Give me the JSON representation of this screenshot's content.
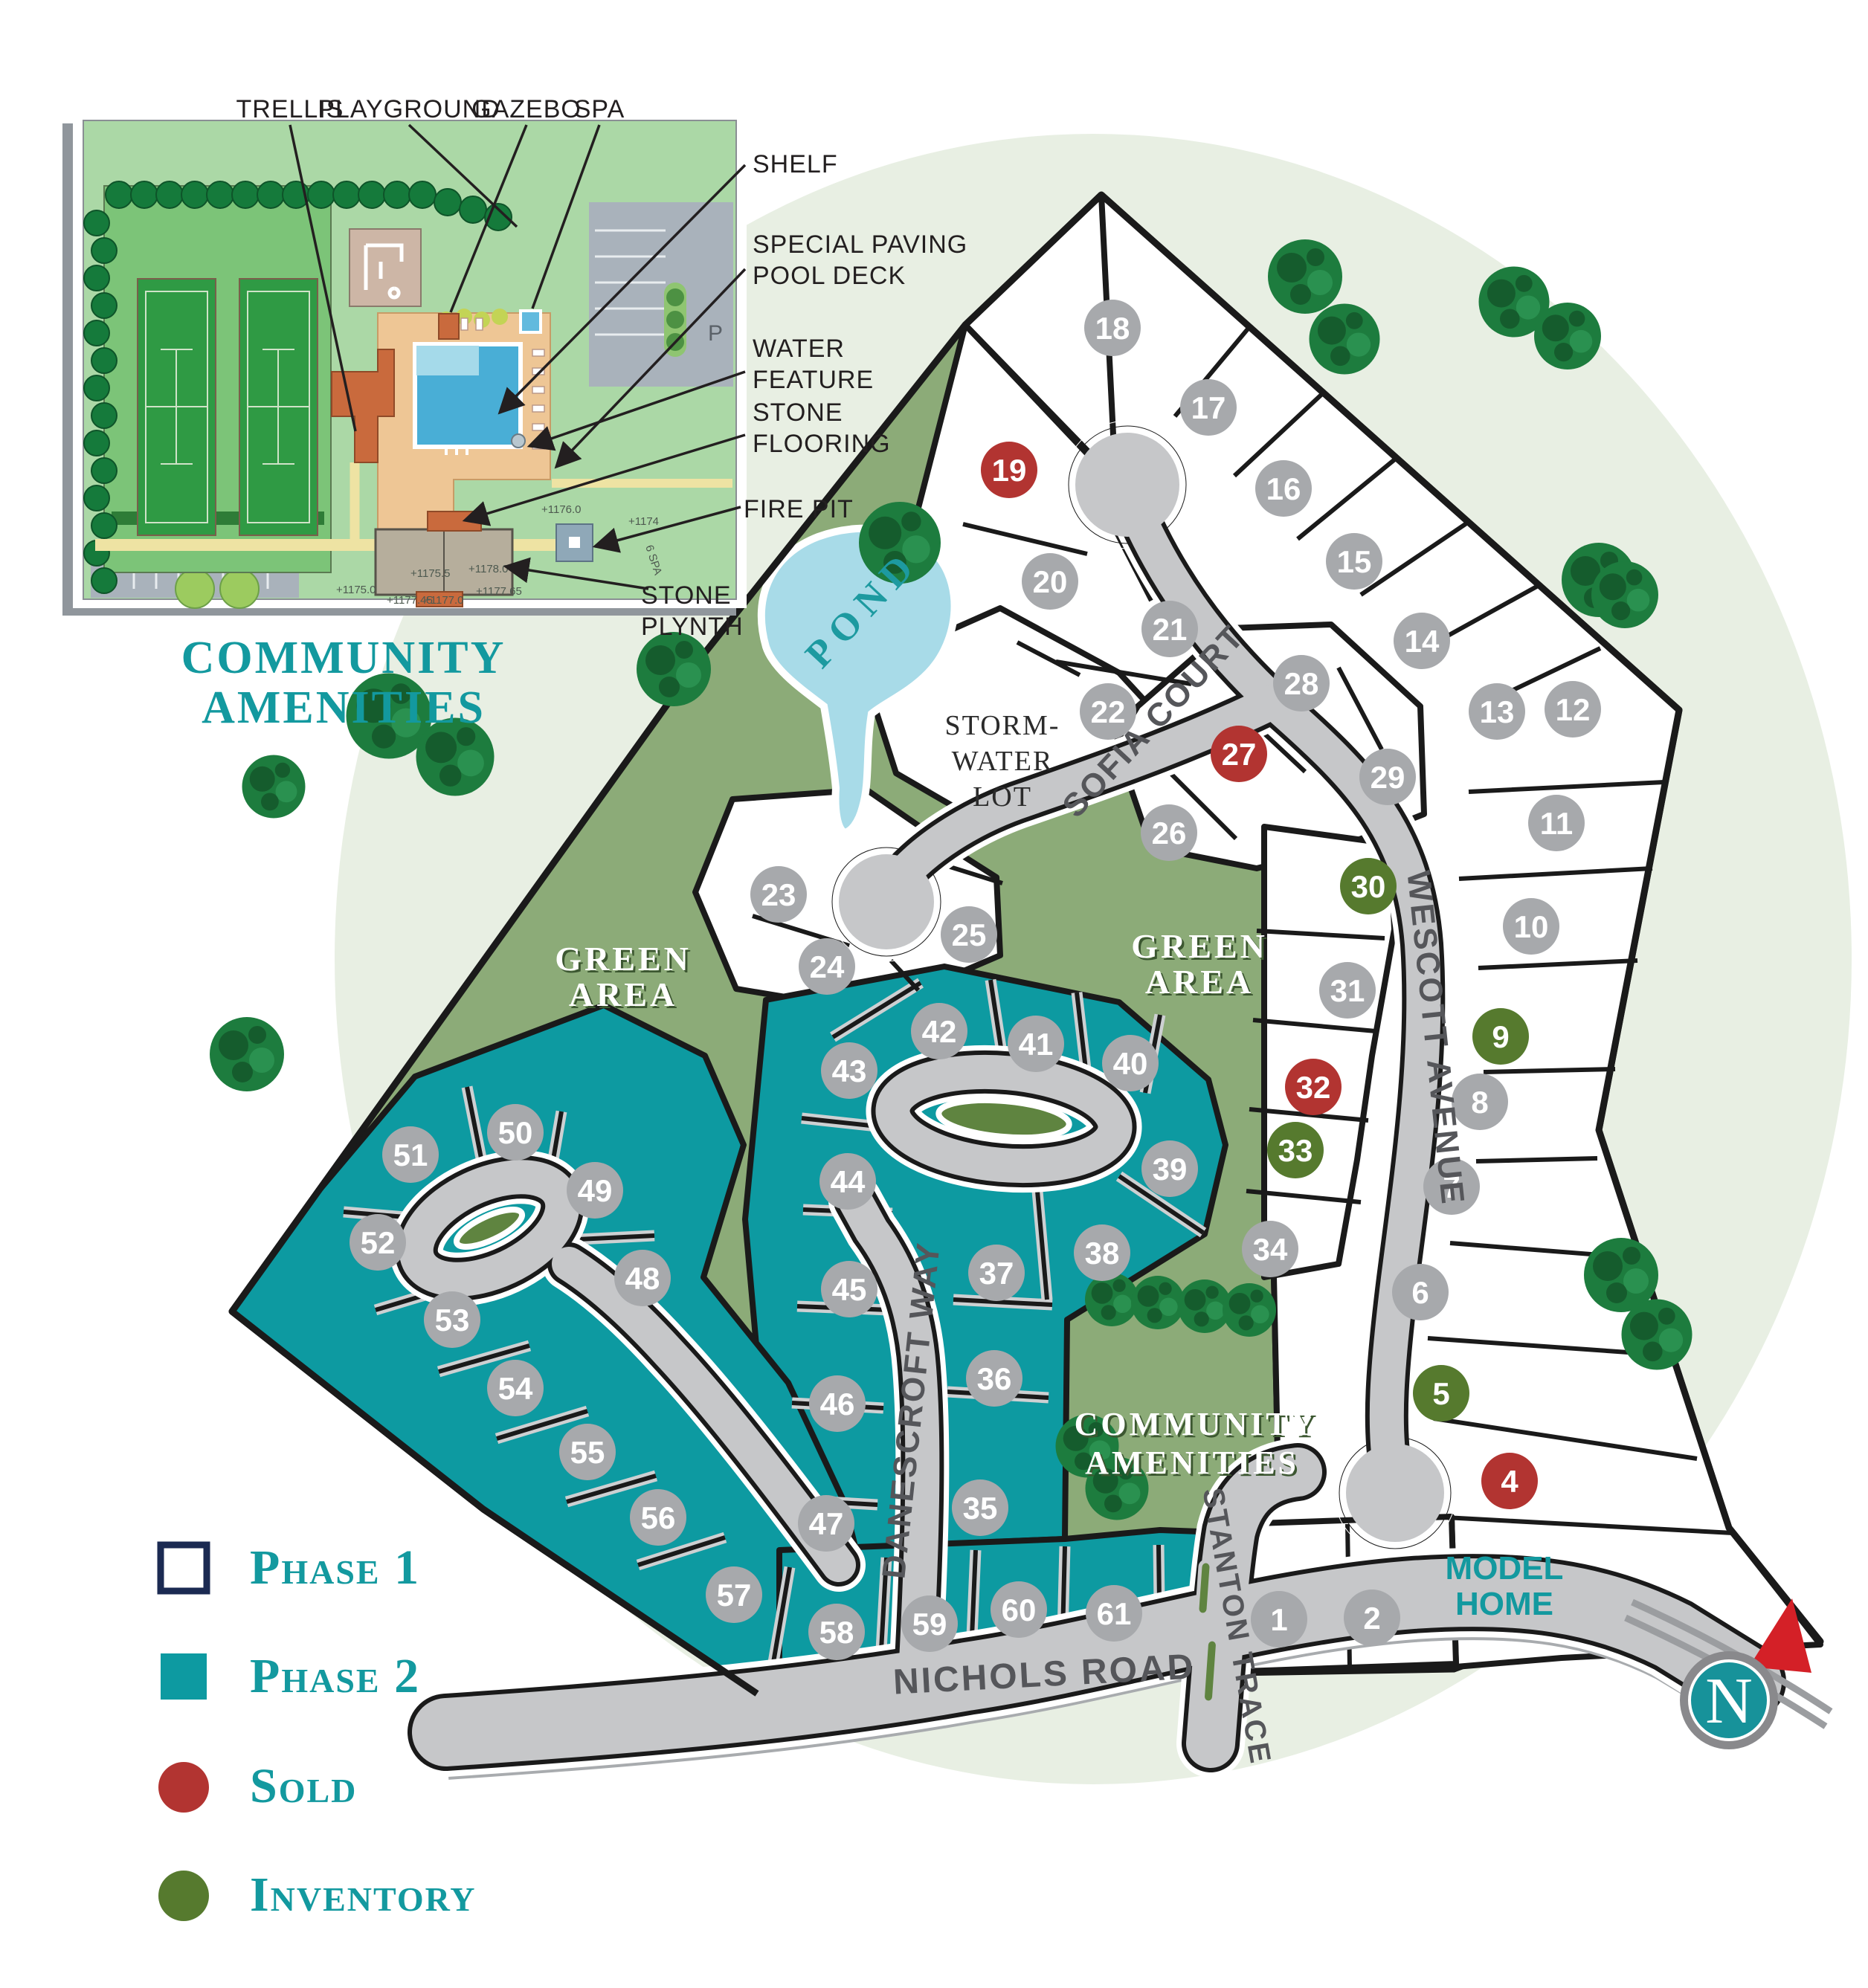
{
  "inset": {
    "title_line1": "COMMUNITY",
    "title_line2": "AMENITIES",
    "callouts": {
      "trellis": "TRELLIS",
      "playground": "PLAYGROUND",
      "gazebo": "GAZEBO",
      "spa": "SPA",
      "shelf": "SHELF",
      "paving1": "SPECIAL PAVING",
      "paving2": "POOL DECK",
      "water1": "WATER",
      "water2": "FEATURE",
      "stone1": "STONE",
      "stone2": "FLOORING",
      "firepit": "FIRE PIT",
      "plynth1": "STONE",
      "plynth2": "PLYNTH"
    },
    "parking": "P",
    "elevations": [
      "+1176.0",
      "+1175.5",
      "+1178.0",
      "+1177.0",
      "+1175.0",
      "+1177.45",
      "+1174",
      "+1177.65",
      "6 SPA"
    ]
  },
  "map": {
    "streets": {
      "sofia": "SOFIA COURT",
      "wescott": "WESCOTT AVENUE",
      "danescroft": "DANESCROFT WAY",
      "stanton": "STANTON TRACE",
      "nichols": "NICHOLS ROAD"
    },
    "labels": {
      "pond": "POND",
      "storm1": "STORM-",
      "storm2": "WATER",
      "storm3": "LOT",
      "green1": "GREEN",
      "green2": "AREA",
      "community1": "COMMUNITY",
      "community2": "AMENITIES",
      "model1": "MODEL",
      "model2": "HOME",
      "compass": "N"
    },
    "statuses": {
      "phase1": "#a7a9ac",
      "phase2": "#a7a9ac",
      "sold": "#b23431",
      "inventory": "#567a2e"
    },
    "lots": [
      {
        "num": 1,
        "status": "phase1"
      },
      {
        "num": 2,
        "status": "phase1"
      },
      {
        "num": 4,
        "status": "sold"
      },
      {
        "num": 5,
        "status": "inventory"
      },
      {
        "num": 6,
        "status": "phase1"
      },
      {
        "num": 7,
        "status": "phase1"
      },
      {
        "num": 8,
        "status": "phase1"
      },
      {
        "num": 9,
        "status": "inventory"
      },
      {
        "num": 10,
        "status": "phase1"
      },
      {
        "num": 11,
        "status": "phase1"
      },
      {
        "num": 12,
        "status": "phase1"
      },
      {
        "num": 13,
        "status": "phase1"
      },
      {
        "num": 14,
        "status": "phase1"
      },
      {
        "num": 15,
        "status": "phase1"
      },
      {
        "num": 16,
        "status": "phase1"
      },
      {
        "num": 17,
        "status": "phase1"
      },
      {
        "num": 18,
        "status": "phase1"
      },
      {
        "num": 19,
        "status": "sold"
      },
      {
        "num": 20,
        "status": "phase1"
      },
      {
        "num": 21,
        "status": "phase1"
      },
      {
        "num": 22,
        "status": "phase1"
      },
      {
        "num": 23,
        "status": "phase1"
      },
      {
        "num": 24,
        "status": "phase1"
      },
      {
        "num": 25,
        "status": "phase1"
      },
      {
        "num": 26,
        "status": "phase1"
      },
      {
        "num": 27,
        "status": "sold"
      },
      {
        "num": 28,
        "status": "phase1"
      },
      {
        "num": 29,
        "status": "phase1"
      },
      {
        "num": 30,
        "status": "inventory"
      },
      {
        "num": 31,
        "status": "phase1"
      },
      {
        "num": 32,
        "status": "sold"
      },
      {
        "num": 33,
        "status": "inventory"
      },
      {
        "num": 34,
        "status": "phase1"
      },
      {
        "num": 35,
        "status": "phase2"
      },
      {
        "num": 36,
        "status": "phase2"
      },
      {
        "num": 37,
        "status": "phase2"
      },
      {
        "num": 38,
        "status": "phase2"
      },
      {
        "num": 39,
        "status": "phase2"
      },
      {
        "num": 40,
        "status": "phase2"
      },
      {
        "num": 41,
        "status": "phase2"
      },
      {
        "num": 42,
        "status": "phase2"
      },
      {
        "num": 43,
        "status": "phase2"
      },
      {
        "num": 44,
        "status": "phase2"
      },
      {
        "num": 45,
        "status": "phase2"
      },
      {
        "num": 46,
        "status": "phase2"
      },
      {
        "num": 47,
        "status": "phase2"
      },
      {
        "num": 48,
        "status": "phase2"
      },
      {
        "num": 49,
        "status": "phase2"
      },
      {
        "num": 50,
        "status": "phase2"
      },
      {
        "num": 51,
        "status": "phase2"
      },
      {
        "num": 52,
        "status": "phase2"
      },
      {
        "num": 53,
        "status": "phase2"
      },
      {
        "num": 54,
        "status": "phase2"
      },
      {
        "num": 55,
        "status": "phase2"
      },
      {
        "num": 56,
        "status": "phase2"
      },
      {
        "num": 57,
        "status": "phase2"
      },
      {
        "num": 58,
        "status": "phase2"
      },
      {
        "num": 59,
        "status": "phase2"
      },
      {
        "num": 60,
        "status": "phase2"
      },
      {
        "num": 61,
        "status": "phase2"
      }
    ]
  },
  "legend": {
    "items": [
      {
        "label": "Phase 1",
        "type": "square-outline"
      },
      {
        "label": "Phase 2",
        "type": "square"
      },
      {
        "label": "Sold",
        "type": "circle"
      },
      {
        "label": "Inventory",
        "type": "circle"
      }
    ]
  },
  "colors": {
    "phase2_teal": "#0d9aa1",
    "sold_red": "#b23431",
    "inventory_green": "#567a2e",
    "accent_teal": "#13999f",
    "navy": "#1b2a52",
    "olive_green": "#8cab78",
    "road_gray": "#c6c7c9",
    "pond_blue": "#a8dbe8"
  }
}
